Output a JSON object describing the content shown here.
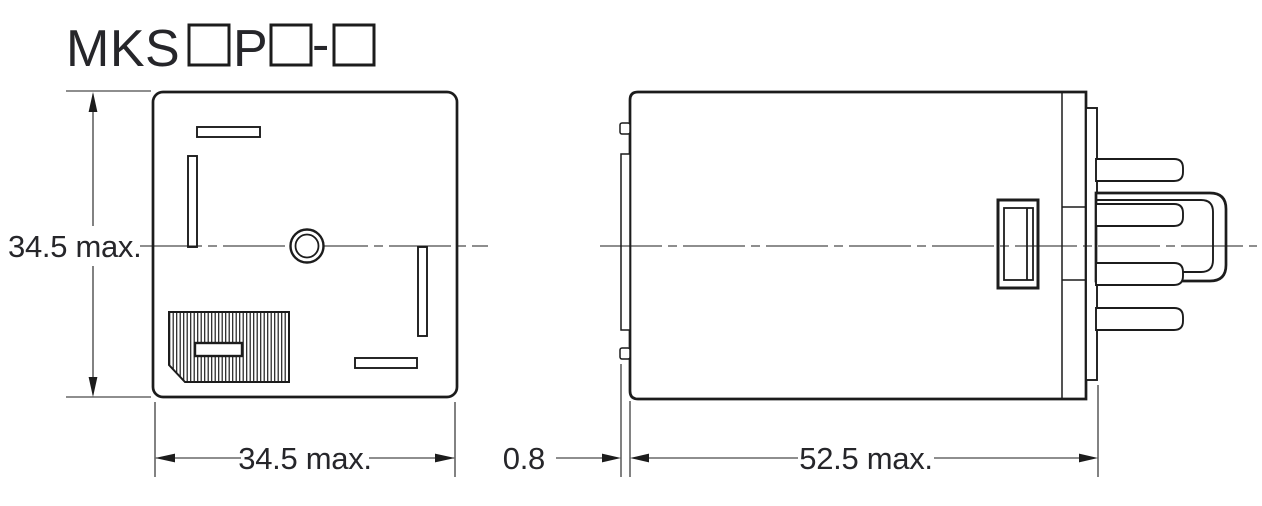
{
  "drawing": {
    "product_code": {
      "display": "MKS□P□-□",
      "prefix": "MKS",
      "infix": "P",
      "separator": "-"
    },
    "front_view": {
      "height_dimension": "34.5 max.",
      "width_dimension": "34.5 max."
    },
    "side_view": {
      "flange_dimension": "0.8",
      "depth_dimension": "52.5 max."
    },
    "colors": {
      "ink": "#1c1c1c",
      "label_ink": "#26262a",
      "background": "#ffffff"
    }
  }
}
